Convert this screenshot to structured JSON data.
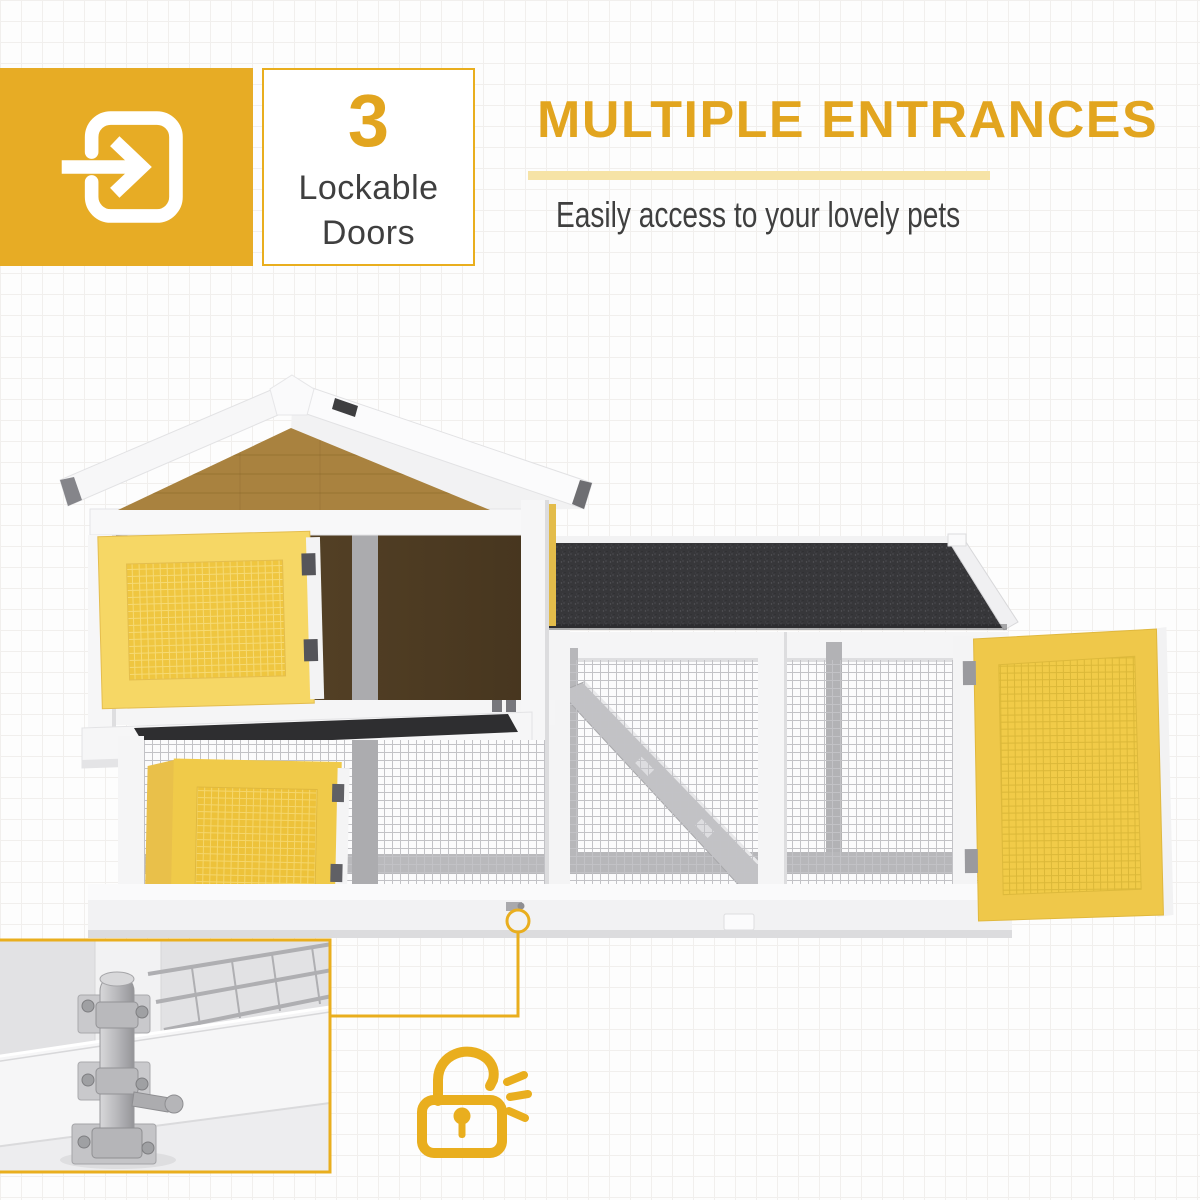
{
  "theme": {
    "background": "#FDFDFD",
    "grid_line": "#F1EFED",
    "accent": "#E2A51F",
    "accent_bright": "#E9AE1E",
    "pale_underline": "#F6E3A6",
    "text_dark": "#3F3F3F",
    "badge_yellow": "#E7AC25",
    "door_yellow": "#EFC640",
    "door_frame_yellow": "#F6D765",
    "roof_black": "#37373A",
    "gable_brown": "#A9823F",
    "interior_brown": "#47361F",
    "structure_white": "#F5F5F6",
    "mesh_gray": "#C2C2C6"
  },
  "feature_badge": {
    "count": "3",
    "label_lines": [
      "Lockable",
      "Doors"
    ],
    "icon": "door-entry-arrow-icon"
  },
  "headline": {
    "title": "MULTIPLE ENTRANCES",
    "subtitle": "Easily access to your lovely pets"
  },
  "illustration": {
    "subject": "two-level wooden pet hutch with wire-mesh outdoor run",
    "features_shown": [
      "open-upper-mesh-door",
      "open-lower-mesh-door",
      "open-run-door",
      "pull-out-tray",
      "ramp",
      "asphalt-run-roof",
      "wire-mesh-panels"
    ],
    "inset": "slide-bolt-latch-closeup-photo",
    "callout_icon": "open-padlock-icon"
  }
}
